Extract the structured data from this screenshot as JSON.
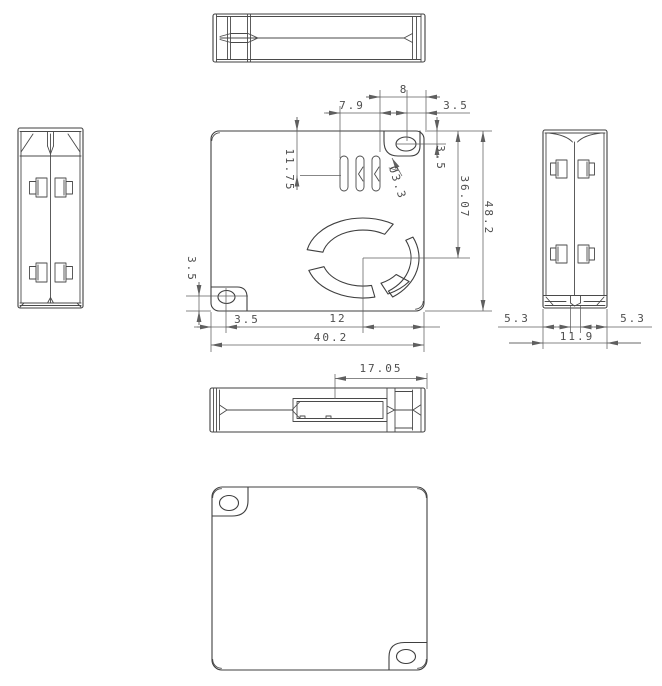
{
  "drawing": {
    "type": "mechanical-orthographic-views",
    "background_color": "#ffffff",
    "line_color": "#3f3f3f",
    "dim_color": "#5f5f5f",
    "dims": {
      "front": {
        "slot_depth": "11.75",
        "hole_offset_left": "7.9",
        "tab_width": "8",
        "hole_to_right_edge": "3.5",
        "hole_to_top_edge": "3.5",
        "fan_center_from_top": "36.07",
        "body_height": "48.2",
        "hole2_to_bottom": "3.5",
        "hole2_to_left": "3.5",
        "fan_center_to_right": "12",
        "body_width": "40.2",
        "hole_diameter": "Ø3.3"
      },
      "side": {
        "left_wall": "5.3",
        "right_wall": "5.3",
        "body_depth": "11.9"
      },
      "bottom": {
        "connector_to_edge": "17.05"
      }
    }
  }
}
